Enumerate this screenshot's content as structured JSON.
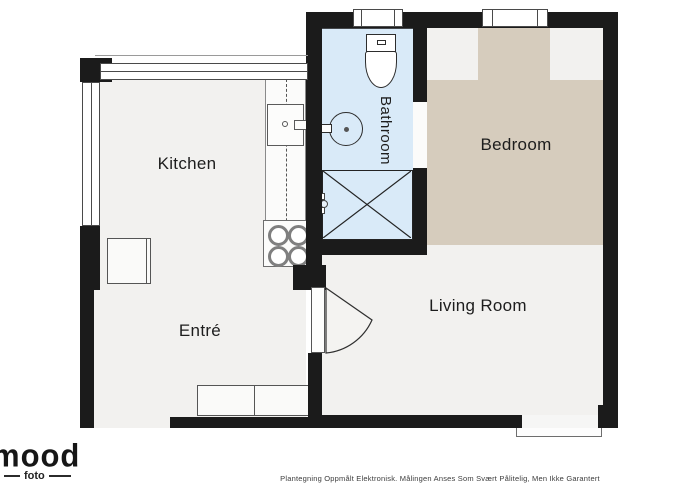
{
  "meta": {
    "title": "Apartment floor plan",
    "canvas_width": 700,
    "canvas_height": 500
  },
  "colors": {
    "page_bg": "#ffffff",
    "wall": "#1b1b1b",
    "floor": "#f2f1ef",
    "bathroom": "#d9eaf8",
    "carpet": "#d6ccbd"
  },
  "rooms": {
    "kitchen": {
      "label": "Kitchen"
    },
    "entre": {
      "label": "Entré"
    },
    "bathroom": {
      "label": "Bathroom"
    },
    "bedroom": {
      "label": "Bedroom"
    },
    "living": {
      "label": "Living Room"
    }
  },
  "fixtures": {
    "bathroom": [
      "toilet",
      "round-sink",
      "shower",
      "shower-valve"
    ],
    "kitchen": [
      "counter",
      "sink-unit",
      "stove-4-burners"
    ],
    "entre": [
      "cabinet",
      "bench"
    ],
    "openings": [
      "bathroom-window",
      "bedroom-window",
      "kitchen-window-band",
      "left-window",
      "entrance-gap",
      "living-room-door",
      "balcony-door"
    ]
  },
  "logo": {
    "brand": "mood",
    "sub": "foto"
  },
  "footer": {
    "disclaimer": "Plantegning Oppmålt Elektronisk. Målingen Anses Som Svært Pålitelig, Men Ikke Garantert"
  }
}
